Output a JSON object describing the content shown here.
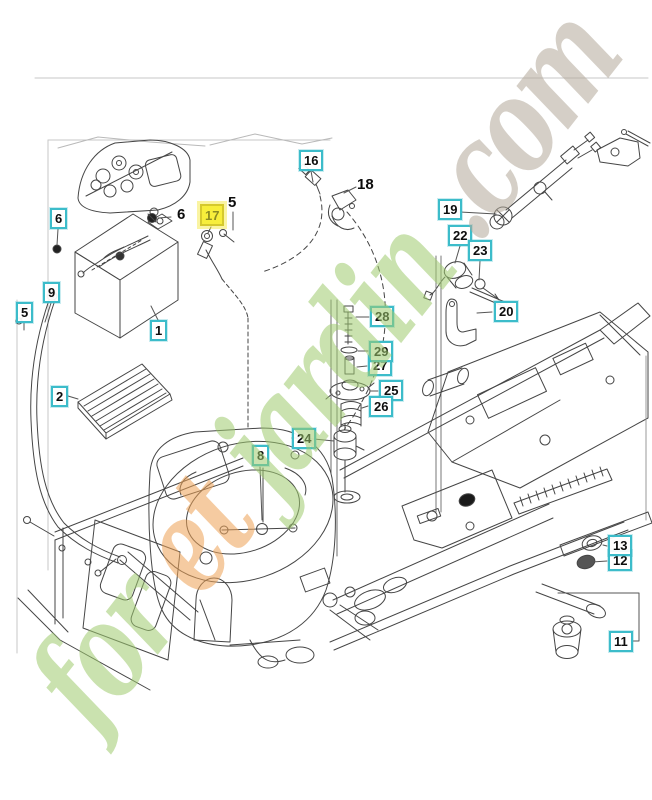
{
  "diagram": {
    "kind": "exploded-parts-diagram",
    "selected_callout": "17"
  },
  "callouts": [
    {
      "num": "1",
      "style": "box"
    },
    {
      "num": "2",
      "style": "box"
    },
    {
      "num": "5",
      "style": "plain"
    },
    {
      "num": "5",
      "style": "box"
    },
    {
      "num": "6",
      "style": "box"
    },
    {
      "num": "6",
      "style": "plain"
    },
    {
      "num": "8",
      "style": "box"
    },
    {
      "num": "9",
      "style": "box"
    },
    {
      "num": "11",
      "style": "box"
    },
    {
      "num": "12",
      "style": "box"
    },
    {
      "num": "13",
      "style": "box"
    },
    {
      "num": "16",
      "style": "box"
    },
    {
      "num": "17",
      "style": "highlight"
    },
    {
      "num": "18",
      "style": "plain"
    },
    {
      "num": "19",
      "style": "box"
    },
    {
      "num": "20",
      "style": "box"
    },
    {
      "num": "22",
      "style": "box"
    },
    {
      "num": "23",
      "style": "box"
    },
    {
      "num": "24",
      "style": "box"
    },
    {
      "num": "25",
      "style": "box"
    },
    {
      "num": "26",
      "style": "box"
    },
    {
      "num": "27",
      "style": "box"
    },
    {
      "num": "28",
      "style": "box"
    },
    {
      "num": "29",
      "style": "box"
    }
  ],
  "watermark": {
    "text": "foretjardin.com",
    "segments": [
      {
        "text": "for",
        "color": "#9fcb6f"
      },
      {
        "text": "et",
        "color": "#eea256"
      },
      {
        "text": "jardin",
        "color": "#9fcb6f"
      },
      {
        "text": ".com",
        "color": "#b3a99a"
      }
    ]
  },
  "colors": {
    "callout_border": "#3cbcca",
    "highlight_bg": "#f7ee3b",
    "highlight_border": "#d5c92d",
    "highlight_text": "#8b8b22",
    "line_art": "#454545"
  }
}
